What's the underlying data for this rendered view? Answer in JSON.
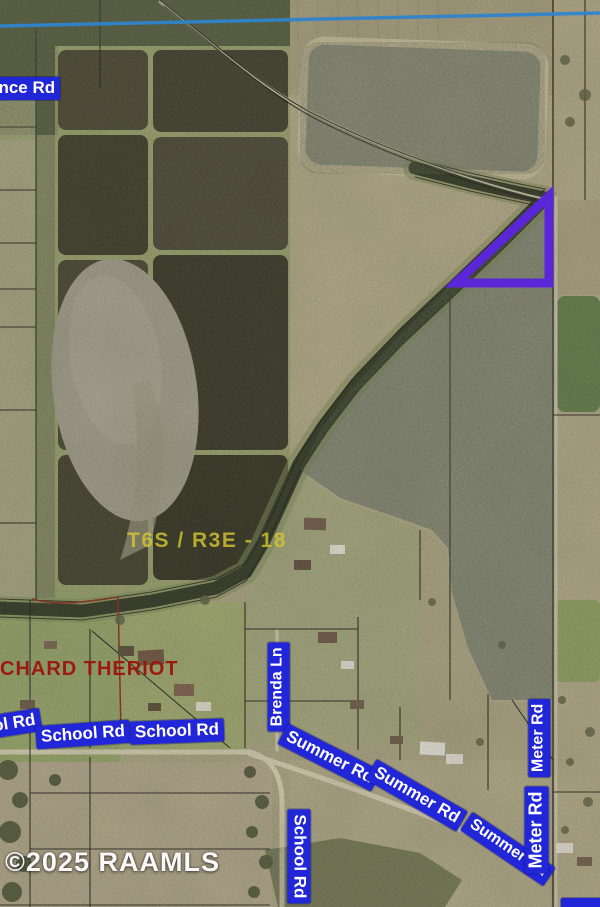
{
  "map": {
    "copyright": "©2025 RAAMLS",
    "section_township_label": "T6S / R3E - 18",
    "owner_parcel_label": "CHARD THERIOT",
    "road_labels": {
      "ence_rd": "ence Rd",
      "ol_rd": "ol Rd",
      "school_rd_1": "School Rd",
      "school_rd_2": "School Rd",
      "school_rd_vertical": "School Rd",
      "brenda_ln": "Brenda Ln",
      "summer_rd_1": "Summer Rd",
      "summer_rd_2": "Summer Rd",
      "summer_rd_3": "Summer Rd",
      "meter_rd_upper": "Meter Rd",
      "meter_rd_lower": "Meter Rd"
    },
    "colors": {
      "road_label_bg": "#2127d8",
      "road_label_text": "#ffffff",
      "parcel_highlight": "#5a26d8",
      "section_label_color": "#d5c82e",
      "owner_label_color": "#9e130b",
      "waterway_line": "#2f84cc",
      "copyright_color": "#ffffff"
    }
  }
}
